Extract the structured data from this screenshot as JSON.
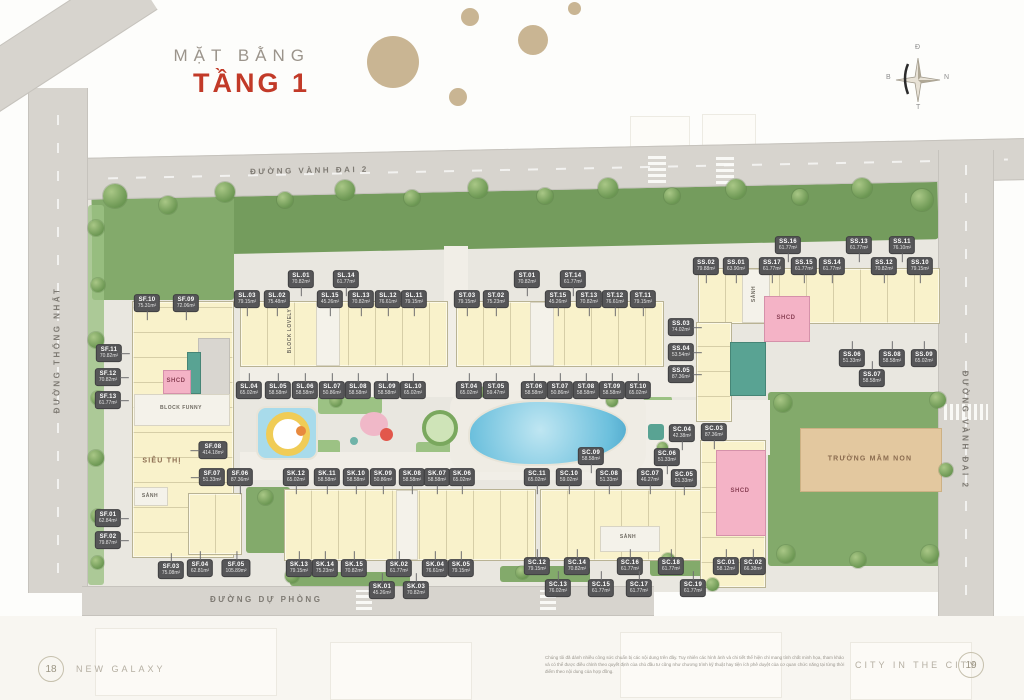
{
  "title": {
    "subtitle": "MẶT BẰNG",
    "main": "TẦNG 1"
  },
  "roads": {
    "top": "ĐƯỜNG VÀNH ĐAI 2",
    "left": "ĐƯỜNG THỐNG NHẤT",
    "bottom": "ĐƯỜNG DỰ PHÒNG",
    "right": "ĐƯỜNG VÀNH ĐAI 2"
  },
  "compass": {
    "top": "Đ",
    "right": "N",
    "bottom": "T",
    "left": "B"
  },
  "colors": {
    "accent_red": "#c23a28",
    "unit_chip": "#565658",
    "building_yellow": "#f9f2cb",
    "shcd_pink": "#f4b3c6",
    "community_teal": "#59a393",
    "kindergarten_beige": "#e3c89f"
  },
  "facilities": [
    {
      "name": "supermarket-label",
      "label": "SIÊU THỊ",
      "x": 162,
      "y": 461,
      "style": "facility"
    },
    {
      "name": "lobby-label",
      "label": "SẢNH",
      "x": 150,
      "y": 496,
      "style": "tiny"
    },
    {
      "name": "lobby-label",
      "label": "SẢNH",
      "x": 754,
      "y": 294,
      "style": "tiny-vert"
    },
    {
      "name": "lobby-label",
      "label": "SẢNH",
      "x": 628,
      "y": 537,
      "style": "tiny"
    },
    {
      "name": "shcd-label",
      "label": "SHCD",
      "x": 176,
      "y": 381,
      "style": "pink-label"
    },
    {
      "name": "shcd-label",
      "label": "SHCD",
      "x": 786,
      "y": 318,
      "style": "pink-label"
    },
    {
      "name": "shcd-label",
      "label": "SHCD",
      "x": 740,
      "y": 491,
      "style": "pink-label"
    },
    {
      "name": "kindergarten-label",
      "label": "TRƯỜNG MẦM NON",
      "x": 870,
      "y": 459,
      "style": "facility"
    },
    {
      "name": "block-name-funny",
      "label": "BLOCK FUNNY",
      "x": 181,
      "y": 408,
      "style": "tiny"
    },
    {
      "name": "block-name-lovely",
      "label": "BLOCK LOVELY",
      "x": 290,
      "y": 331,
      "style": "tiny-vert"
    }
  ],
  "units": [
    {
      "code": "SF.10",
      "area": "75.31m²",
      "x": 147,
      "y": 303,
      "lead": "down"
    },
    {
      "code": "SF.09",
      "area": "72.06m²",
      "x": 186,
      "y": 303,
      "lead": "down"
    },
    {
      "code": "SF.11",
      "area": "70.82m²",
      "x": 109,
      "y": 353,
      "lead": "right"
    },
    {
      "code": "SF.12",
      "area": "70.82m²",
      "x": 108,
      "y": 377,
      "lead": "right"
    },
    {
      "code": "SF.13",
      "area": "61.77m²",
      "x": 108,
      "y": 400,
      "lead": "right"
    },
    {
      "code": "SF.08",
      "area": "414.18m²",
      "x": 213,
      "y": 450,
      "lead": "left"
    },
    {
      "code": "SF.07",
      "area": "51.33m²",
      "x": 212,
      "y": 477,
      "lead": "left"
    },
    {
      "code": "SF.06",
      "area": "87.36m²",
      "x": 240,
      "y": 477,
      "lead": "down"
    },
    {
      "code": "SF.01",
      "area": "62.84m²",
      "x": 108,
      "y": 518,
      "lead": "right"
    },
    {
      "code": "SF.02",
      "area": "79.87m²",
      "x": 108,
      "y": 540,
      "lead": "right"
    },
    {
      "code": "SF.03",
      "area": "75.08m²",
      "x": 171,
      "y": 570,
      "lead": "up"
    },
    {
      "code": "SF.04",
      "area": "62.81m²",
      "x": 200,
      "y": 568,
      "lead": "up"
    },
    {
      "code": "SF.05",
      "area": "105.89m²",
      "x": 236,
      "y": 568,
      "lead": "up"
    },
    {
      "code": "SL.01",
      "area": "70.82m²",
      "x": 301,
      "y": 279,
      "lead": "down"
    },
    {
      "code": "SL.14",
      "area": "61.77m²",
      "x": 346,
      "y": 279,
      "lead": "down"
    },
    {
      "code": "SL.03",
      "area": "79.15m²",
      "x": 247,
      "y": 299,
      "lead": "down"
    },
    {
      "code": "SL.02",
      "area": "75.48m²",
      "x": 277,
      "y": 299,
      "lead": "down"
    },
    {
      "code": "SL.15",
      "area": "45.26m²",
      "x": 330,
      "y": 299,
      "lead": "down"
    },
    {
      "code": "SL.13",
      "area": "70.82m²",
      "x": 361,
      "y": 299,
      "lead": "down"
    },
    {
      "code": "SL.12",
      "area": "76.61m²",
      "x": 388,
      "y": 299,
      "lead": "down"
    },
    {
      "code": "SL.11",
      "area": "79.15m²",
      "x": 414,
      "y": 299,
      "lead": "down"
    },
    {
      "code": "SL.04",
      "area": "65.02m²",
      "x": 249,
      "y": 390,
      "lead": "up"
    },
    {
      "code": "SL.05",
      "area": "58.58m²",
      "x": 278,
      "y": 390,
      "lead": "up"
    },
    {
      "code": "SL.06",
      "area": "58.58m²",
      "x": 305,
      "y": 390,
      "lead": "up"
    },
    {
      "code": "SL.07",
      "area": "50.86m²",
      "x": 332,
      "y": 390,
      "lead": "up"
    },
    {
      "code": "SL.08",
      "area": "58.58m²",
      "x": 358,
      "y": 390,
      "lead": "up"
    },
    {
      "code": "SL.09",
      "area": "58.58m²",
      "x": 387,
      "y": 390,
      "lead": "up"
    },
    {
      "code": "SL.10",
      "area": "65.02m²",
      "x": 413,
      "y": 390,
      "lead": "up"
    },
    {
      "code": "ST.01",
      "area": "70.82m²",
      "x": 527,
      "y": 279,
      "lead": "down"
    },
    {
      "code": "ST.14",
      "area": "61.77m²",
      "x": 573,
      "y": 279,
      "lead": "down"
    },
    {
      "code": "ST.03",
      "area": "79.15m²",
      "x": 467,
      "y": 299,
      "lead": "down"
    },
    {
      "code": "ST.02",
      "area": "75.23m²",
      "x": 496,
      "y": 299,
      "lead": "down"
    },
    {
      "code": "ST.15",
      "area": "45.26m²",
      "x": 558,
      "y": 299,
      "lead": "down"
    },
    {
      "code": "ST.13",
      "area": "70.82m²",
      "x": 589,
      "y": 299,
      "lead": "down"
    },
    {
      "code": "ST.12",
      "area": "76.61m²",
      "x": 615,
      "y": 299,
      "lead": "down"
    },
    {
      "code": "ST.11",
      "area": "79.15m²",
      "x": 643,
      "y": 299,
      "lead": "down"
    },
    {
      "code": "ST.04",
      "area": "65.02m²",
      "x": 469,
      "y": 390,
      "lead": "up"
    },
    {
      "code": "ST.05",
      "area": "59.47m²",
      "x": 496,
      "y": 390,
      "lead": "up"
    },
    {
      "code": "ST.06",
      "area": "58.58m²",
      "x": 534,
      "y": 390,
      "lead": "up"
    },
    {
      "code": "ST.07",
      "area": "50.86m²",
      "x": 560,
      "y": 390,
      "lead": "up"
    },
    {
      "code": "ST.08",
      "area": "58.58m²",
      "x": 586,
      "y": 390,
      "lead": "up"
    },
    {
      "code": "ST.09",
      "area": "58.58m²",
      "x": 612,
      "y": 390,
      "lead": "up"
    },
    {
      "code": "ST.10",
      "area": "65.02m²",
      "x": 638,
      "y": 390,
      "lead": "up"
    },
    {
      "code": "SS.16",
      "area": "61.77m²",
      "x": 788,
      "y": 245,
      "lead": "down"
    },
    {
      "code": "SS.13",
      "area": "61.77m²",
      "x": 859,
      "y": 245,
      "lead": "down"
    },
    {
      "code": "SS.11",
      "area": "76.10m²",
      "x": 902,
      "y": 245,
      "lead": "down"
    },
    {
      "code": "SS.02",
      "area": "79.88m²",
      "x": 706,
      "y": 266,
      "lead": "down"
    },
    {
      "code": "SS.01",
      "area": "63.90m²",
      "x": 736,
      "y": 266,
      "lead": "down"
    },
    {
      "code": "SS.17",
      "area": "61.77m²",
      "x": 772,
      "y": 266,
      "lead": "down"
    },
    {
      "code": "SS.15",
      "area": "61.77m²",
      "x": 804,
      "y": 266,
      "lead": "down"
    },
    {
      "code": "SS.14",
      "area": "61.77m²",
      "x": 832,
      "y": 266,
      "lead": "down"
    },
    {
      "code": "SS.12",
      "area": "70.82m²",
      "x": 884,
      "y": 266,
      "lead": "down"
    },
    {
      "code": "SS.10",
      "area": "79.15m²",
      "x": 920,
      "y": 266,
      "lead": "down"
    },
    {
      "code": "SS.03",
      "area": "74.02m²",
      "x": 681,
      "y": 327,
      "lead": "right"
    },
    {
      "code": "SS.04",
      "area": "53.54m²",
      "x": 681,
      "y": 352,
      "lead": "right"
    },
    {
      "code": "SS.05",
      "area": "87.36m²",
      "x": 681,
      "y": 374,
      "lead": "right"
    },
    {
      "code": "SS.06",
      "area": "51.33m²",
      "x": 852,
      "y": 358,
      "lead": "up"
    },
    {
      "code": "SS.08",
      "area": "58.58m²",
      "x": 892,
      "y": 358,
      "lead": "up"
    },
    {
      "code": "SS.09",
      "area": "65.02m²",
      "x": 924,
      "y": 358,
      "lead": "up"
    },
    {
      "code": "SS.07",
      "area": "58.58m²",
      "x": 872,
      "y": 378,
      "lead": "up"
    },
    {
      "code": "SK.12",
      "area": "65.02m²",
      "x": 296,
      "y": 477,
      "lead": "down"
    },
    {
      "code": "SK.11",
      "area": "58.58m²",
      "x": 327,
      "y": 477,
      "lead": "down"
    },
    {
      "code": "SK.10",
      "area": "58.58m²",
      "x": 356,
      "y": 477,
      "lead": "down"
    },
    {
      "code": "SK.09",
      "area": "50.86m²",
      "x": 383,
      "y": 477,
      "lead": "down"
    },
    {
      "code": "SK.08",
      "area": "58.58m²",
      "x": 412,
      "y": 477,
      "lead": "down"
    },
    {
      "code": "SK.07",
      "area": "58.58m²",
      "x": 437,
      "y": 477,
      "lead": "down"
    },
    {
      "code": "SK.06",
      "area": "65.02m²",
      "x": 462,
      "y": 477,
      "lead": "down"
    },
    {
      "code": "SK.13",
      "area": "79.15m²",
      "x": 299,
      "y": 568,
      "lead": "up"
    },
    {
      "code": "SK.14",
      "area": "75.23m²",
      "x": 325,
      "y": 568,
      "lead": "up"
    },
    {
      "code": "SK.15",
      "area": "70.82m²",
      "x": 354,
      "y": 568,
      "lead": "up"
    },
    {
      "code": "SK.02",
      "area": "61.77m²",
      "x": 399,
      "y": 568,
      "lead": "up"
    },
    {
      "code": "SK.04",
      "area": "76.61m²",
      "x": 435,
      "y": 568,
      "lead": "up"
    },
    {
      "code": "SK.05",
      "area": "79.15m²",
      "x": 461,
      "y": 568,
      "lead": "up"
    },
    {
      "code": "SK.01",
      "area": "45.26m²",
      "x": 382,
      "y": 590,
      "lead": "up"
    },
    {
      "code": "SK.03",
      "area": "70.82m²",
      "x": 416,
      "y": 590,
      "lead": "up"
    },
    {
      "code": "SC.09",
      "area": "58.58m²",
      "x": 591,
      "y": 456,
      "lead": "down"
    },
    {
      "code": "SC.11",
      "area": "65.02m²",
      "x": 537,
      "y": 477,
      "lead": "down"
    },
    {
      "code": "SC.10",
      "area": "59.02m²",
      "x": 569,
      "y": 477,
      "lead": "down"
    },
    {
      "code": "SC.08",
      "area": "51.33m²",
      "x": 609,
      "y": 477,
      "lead": "down"
    },
    {
      "code": "SC.04",
      "area": "42.38m²",
      "x": 682,
      "y": 433,
      "lead": "down"
    },
    {
      "code": "SC.03",
      "area": "87.36m²",
      "x": 714,
      "y": 432,
      "lead": "down"
    },
    {
      "code": "SC.06",
      "area": "51.33m²",
      "x": 667,
      "y": 457,
      "lead": "down"
    },
    {
      "code": "SC.07",
      "area": "46.27m²",
      "x": 650,
      "y": 477,
      "lead": "down"
    },
    {
      "code": "SC.05",
      "area": "51.33m²",
      "x": 684,
      "y": 478,
      "lead": "down"
    },
    {
      "code": "SC.12",
      "area": "79.15m²",
      "x": 537,
      "y": 566,
      "lead": "up"
    },
    {
      "code": "SC.14",
      "area": "70.82m²",
      "x": 577,
      "y": 566,
      "lead": "up"
    },
    {
      "code": "SC.16",
      "area": "61.77m²",
      "x": 630,
      "y": 566,
      "lead": "up"
    },
    {
      "code": "SC.18",
      "area": "61.77m²",
      "x": 671,
      "y": 566,
      "lead": "up"
    },
    {
      "code": "SC.01",
      "area": "58.12m²",
      "x": 726,
      "y": 566,
      "lead": "up"
    },
    {
      "code": "SC.02",
      "area": "66.38m²",
      "x": 753,
      "y": 566,
      "lead": "up"
    },
    {
      "code": "SC.13",
      "area": "76.02m²",
      "x": 558,
      "y": 588,
      "lead": "up"
    },
    {
      "code": "SC.15",
      "area": "61.77m²",
      "x": 601,
      "y": 588,
      "lead": "up"
    },
    {
      "code": "SC.17",
      "area": "61.77m²",
      "x": 639,
      "y": 588,
      "lead": "up"
    },
    {
      "code": "SC.19",
      "area": "61.77m²",
      "x": 693,
      "y": 588,
      "lead": "up"
    }
  ],
  "footer": {
    "page_left": "18",
    "brand_left": "NEW GALAXY",
    "disclaimer": "Chúng tôi đã dành nhiều công sức chuẩn bị các nội dung trên đây. Tuy nhiên các hình ảnh và chi tiết thể hiện chỉ mang tính chất minh họa, tham khảo và có thể được điều chỉnh theo quyết định của chủ đầu tư cũng như chương trình kỹ thuật hay tiện ích phê duyệt của cơ quan chức năng tại từng thời điểm theo nội dung của hợp đồng.",
    "brand_right": "CITY IN THE CITY",
    "page_right": "19"
  }
}
